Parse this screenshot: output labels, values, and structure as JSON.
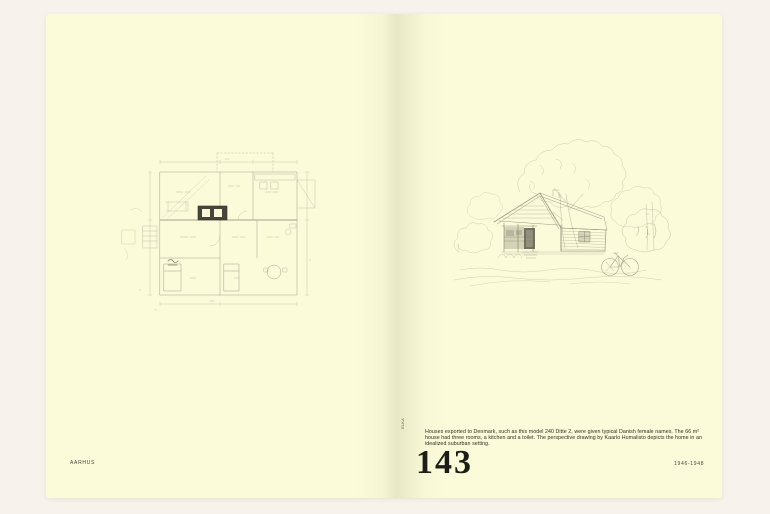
{
  "colors": {
    "background": "#f7f3ec",
    "page": "#fbfbda",
    "ink": "#1d1d18",
    "pencil": "#8c8b78"
  },
  "left_page": {
    "drawing_name": "floor-plan-sketch",
    "footer": "AARHUS"
  },
  "right_page": {
    "drawing_name": "house-perspective-sketch",
    "credit_vertical": "ELKA",
    "caption": "Houses exported to Denmark, such as this model 240 Ditte 2, were given typical Danish female names. The 66 m² house had three rooms, a kitchen and a toilet. The perspective drawing by Kaarlo Humalisto depicts the home in an idealized suburban setting.",
    "page_number": "143",
    "footer": "1946-1948"
  }
}
